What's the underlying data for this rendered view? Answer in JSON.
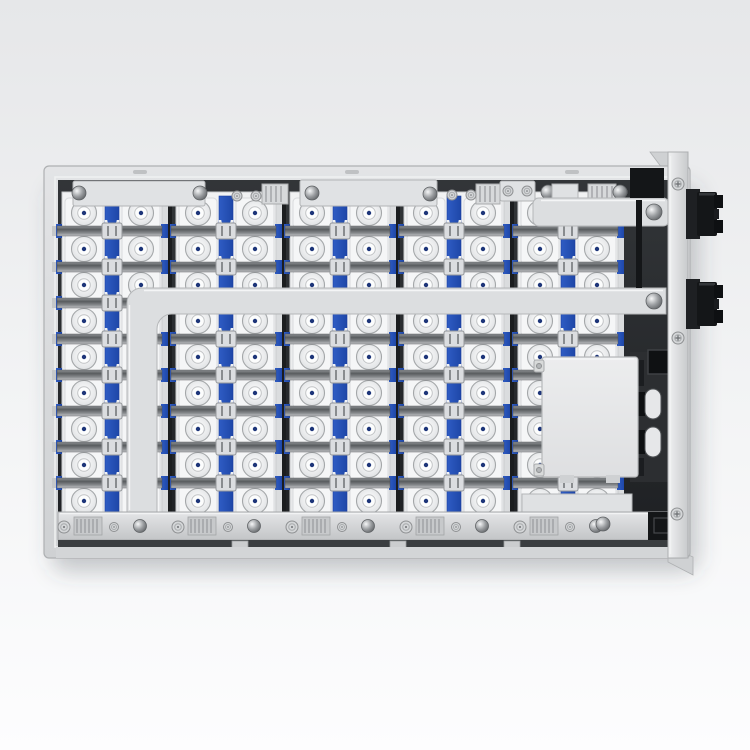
{
  "scene": {
    "description": "Top view 3D render of an EV battery pack: five columns of prismatic cells with blue retention strips, metal busbars, junction box and two black power connectors on the right side",
    "canvas": {
      "w": 750,
      "h": 750
    },
    "colors": {
      "bgTop": "#e6e7e9",
      "bgMid": "#f3f4f5",
      "bgBottom": "#fdfdfe",
      "shadow": "rgba(70,75,80,0.28)",
      "caseLight": "#e3e4e6",
      "caseMid": "#cfd1d3",
      "caseEdge": "#aeb0b2",
      "interiorTop": "#323538",
      "interiorBottom": "#1e2023",
      "cellTop": "#f1f2f3",
      "cellBottom": "#e7e8ea",
      "cellEdge": "#c9cbcd",
      "padWhite": "#f5f6f7",
      "padEdge": "#d9dbdd",
      "blueLight": "#2f5cc4",
      "blueDark": "#1e47a8",
      "blueEdge": "#1b3f9e",
      "blueDot": "#1d3579",
      "busA": "#8f9295",
      "busB": "#595c5f",
      "busC": "#86898c",
      "busD": "#c2c4c6",
      "beam": "#dcdee0",
      "beamEdge": "#b5b7b9",
      "beamHi": "#f4f5f6",
      "metal": "#e0e2e4",
      "metalEdge": "#b2b4b6",
      "ribFill": "#d7d9db",
      "ribLine": "#97999c",
      "black": "#141618",
      "blackSoft": "#1b1d20",
      "blackHi": "#34373a",
      "screwFill": "#d4d6d8",
      "screwEdge": "#8f9193",
      "screwDetail": "#6b6e71",
      "domeHi": "#f6f7f8",
      "domeMid": "#9a9da0",
      "domeLo": "#5f6265",
      "railTop": "#e4e5e7",
      "railBottom": "#c3c5c7",
      "gapDark": "#3a3d40",
      "flangeHi": "#f0f1f2",
      "flangeLo": "#c8cacc",
      "boxTop": "#ecedee",
      "boxBottom": "#dedfe1",
      "boxEdge": "#b6b8ba",
      "sepLine": "#1b1d1f",
      "edgeStrip": "#dadcde",
      "termEdge": "#a4a7a9"
    },
    "pack": {
      "case": {
        "x": 44,
        "y": 166,
        "w": 646,
        "h": 392,
        "rx": 5
      },
      "lipSlots": [
        133,
        345,
        565
      ],
      "interior": {
        "x": 58,
        "y": 180,
        "w": 616,
        "h": 366
      },
      "columns": {
        "count": 5,
        "left": 62,
        "pitch": 114,
        "width": 100,
        "top": 192,
        "height": 321,
        "stripX": 43,
        "stripW": 14,
        "sepX": 106,
        "sepW": 4,
        "terminalOffsets": [
          22,
          79
        ]
      },
      "rows": {
        "count": 9,
        "firstY": 213,
        "pitch": 36
      },
      "busbars": {
        "count": 8,
        "firstY": 231,
        "pitch": 36
      }
    },
    "topBrackets": {
      "plates": [
        [
          73,
          181,
          132,
          25
        ],
        [
          300,
          180,
          137,
          26
        ],
        [
          500,
          181,
          35,
          20
        ]
      ],
      "domes": [
        [
          79,
          193
        ],
        [
          200,
          193
        ],
        [
          312,
          193
        ],
        [
          430,
          194
        ],
        [
          548,
          192
        ],
        [
          620,
          192
        ]
      ],
      "screws": [
        [
          237,
          196
        ],
        [
          256,
          196
        ],
        [
          452,
          195
        ],
        [
          471,
          195
        ],
        [
          508,
          191
        ],
        [
          527,
          191
        ],
        [
          570,
          190
        ],
        [
          622,
          192
        ]
      ],
      "ribs": [
        [
          262,
          184,
          26,
          20
        ],
        [
          476,
          184,
          24,
          20
        ],
        [
          588,
          184,
          28,
          18
        ]
      ]
    },
    "beam": {
      "path": "M666 288 L142 288 A15 15 0 0 0 127 303 L127 512 L157 512 L157 329 A15 15 0 0 1 172 314 L666 314 Z",
      "topHiX1": 144,
      "topHiX2": 663,
      "topHiY": 290.5,
      "dome": [
        654,
        301
      ]
    },
    "upperBusbar": {
      "bar": [
        533,
        198,
        136,
        28
      ],
      "stub": [
        552,
        184,
        26,
        16
      ],
      "dome": [
        654,
        212
      ]
    },
    "junctionBox": {
      "backPanel": [
        630,
        352,
        40,
        130
      ],
      "blackSquare": [
        648,
        350,
        24,
        24
      ],
      "slots": [
        [
          645,
          389,
          16,
          30
        ],
        [
          645,
          427,
          16,
          30
        ]
      ],
      "notches": [
        [
          633,
          392,
          12,
          24
        ],
        [
          633,
          430,
          12,
          24
        ]
      ],
      "sideBlacks": [
        [
          633,
          360,
          11,
          26
        ],
        [
          633,
          458,
          11,
          18
        ]
      ],
      "box": [
        542,
        357,
        96,
        120
      ],
      "tabs": [
        [
          534,
          360,
          10,
          12
        ],
        [
          534,
          464,
          10,
          12
        ]
      ],
      "bottomTabs": [
        [
          560,
          475,
          14,
          8
        ],
        [
          606,
          475,
          14,
          8
        ]
      ]
    },
    "bottomRail": {
      "rightPlate": [
        522,
        494,
        110,
        20
      ],
      "rail": [
        58,
        512,
        610,
        28
      ],
      "gap": [
        58,
        540,
        610,
        7
      ],
      "lip": [
        56,
        547,
        618,
        11
      ],
      "tabs": [
        240,
        398,
        512
      ],
      "extraDome": [
        603,
        524
      ]
    },
    "rightInterior": {
      "blocks": [
        [
          630,
          168,
          34,
          30
        ],
        [
          636,
          200,
          6,
          88
        ],
        [
          648,
          512,
          30,
          28
        ]
      ],
      "innerSquare": [
        654,
        518,
        15,
        15
      ]
    },
    "flange": {
      "rect": [
        668,
        152,
        20,
        406
      ],
      "topWedge": "M650 152 L668 152 L668 176 Z",
      "bottomFlap": "M668 546 L693 557 L693 575 L668 562 Z",
      "screws": [
        [
          678,
          184
        ],
        [
          678,
          338
        ],
        [
          677,
          514
        ]
      ]
    },
    "connectors": {
      "x": 686,
      "yStarts": [
        189,
        279
      ],
      "height": 50
    }
  }
}
